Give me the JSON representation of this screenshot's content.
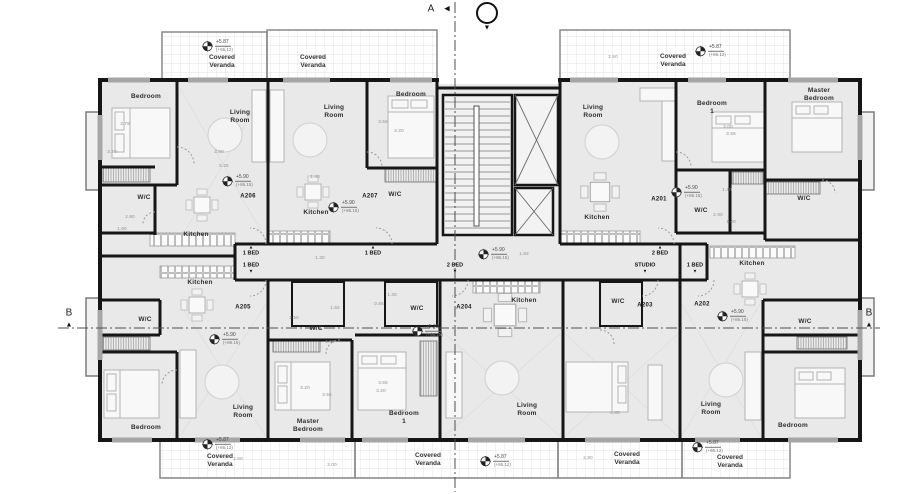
{
  "colors": {
    "wall": "#161616",
    "room_fill": "#e9e9e9",
    "veranda_fill": "#f5f5f5",
    "window": "#a6a6a6",
    "dim_text": "#8d8d8d",
    "label_text": "#2e2e2e",
    "section_line": "#555555"
  },
  "units": [
    {
      "id": "A206",
      "x": 248,
      "y": 197
    },
    {
      "id": "A207",
      "x": 370,
      "y": 197
    },
    {
      "id": "A201",
      "x": 659,
      "y": 200
    },
    {
      "id": "A205",
      "x": 243,
      "y": 308
    },
    {
      "id": "A204",
      "x": 464,
      "y": 308
    },
    {
      "id": "A203",
      "x": 645,
      "y": 306
    },
    {
      "id": "A202",
      "x": 702,
      "y": 305
    }
  ],
  "rooms": [
    {
      "text": "Bedroom",
      "x": 146,
      "y": 97
    },
    {
      "text": "Living\nRoom",
      "x": 240,
      "y": 117
    },
    {
      "text": "W/C",
      "x": 144,
      "y": 198
    },
    {
      "text": "Kitchen",
      "x": 196,
      "y": 235
    },
    {
      "text": "Living\nRoom",
      "x": 334,
      "y": 112
    },
    {
      "text": "Bedroom",
      "x": 411,
      "y": 95
    },
    {
      "text": "W/C",
      "x": 395,
      "y": 195
    },
    {
      "text": "Kitchen",
      "x": 316,
      "y": 213
    },
    {
      "text": "Living\nRoom",
      "x": 593,
      "y": 112
    },
    {
      "text": "Kitchen",
      "x": 597,
      "y": 218
    },
    {
      "text": "Bedroom\n1",
      "x": 712,
      "y": 108
    },
    {
      "text": "Master\nBedroom",
      "x": 819,
      "y": 95
    },
    {
      "text": "W/C",
      "x": 701,
      "y": 211
    },
    {
      "text": "W/C",
      "x": 804,
      "y": 199
    },
    {
      "text": "Kitchen",
      "x": 200,
      "y": 283
    },
    {
      "text": "W/C",
      "x": 145,
      "y": 320
    },
    {
      "text": "Bedroom",
      "x": 146,
      "y": 428
    },
    {
      "text": "Living\nRoom",
      "x": 243,
      "y": 412
    },
    {
      "text": "W/C",
      "x": 316,
      "y": 329
    },
    {
      "text": "Master\nBedroom",
      "x": 308,
      "y": 426
    },
    {
      "text": "Bedroom\n1",
      "x": 404,
      "y": 418
    },
    {
      "text": "W/C",
      "x": 417,
      "y": 309
    },
    {
      "text": "Kitchen",
      "x": 524,
      "y": 301
    },
    {
      "text": "Living\nRoom",
      "x": 527,
      "y": 410
    },
    {
      "text": "W/C",
      "x": 618,
      "y": 302
    },
    {
      "text": "Kitchen",
      "x": 752,
      "y": 264
    },
    {
      "text": "W/C",
      "x": 805,
      "y": 322
    },
    {
      "text": "Living\nRoom",
      "x": 711,
      "y": 409
    },
    {
      "text": "Bedroom",
      "x": 793,
      "y": 426
    }
  ],
  "corridor_labels": [
    {
      "text": "1 BED",
      "x": 251,
      "y": 251,
      "tri": "up"
    },
    {
      "text": "1 BED",
      "x": 373,
      "y": 251,
      "tri": "up"
    },
    {
      "text": "2 BED",
      "x": 660,
      "y": 251,
      "tri": "up"
    },
    {
      "text": "1 BED",
      "x": 251,
      "y": 268,
      "tri": "down"
    },
    {
      "text": "2 BED",
      "x": 455,
      "y": 268,
      "tri": "down"
    },
    {
      "text": "STUDIO",
      "x": 645,
      "y": 268,
      "tri": "down"
    },
    {
      "text": "1 BED",
      "x": 695,
      "y": 268,
      "tri": "down"
    }
  ],
  "veranda_labels": [
    {
      "text": "Covered\nVeranda",
      "x": 222,
      "y": 62
    },
    {
      "text": "Covered\nVeranda",
      "x": 313,
      "y": 62
    },
    {
      "text": "Covered\nVeranda",
      "x": 673,
      "y": 61
    },
    {
      "text": "Covered\nVeranda",
      "x": 220,
      "y": 461
    },
    {
      "text": "Covered\nVeranda",
      "x": 428,
      "y": 460
    },
    {
      "text": "Covered\nVeranda",
      "x": 627,
      "y": 459
    },
    {
      "text": "Covered\nVeranda",
      "x": 730,
      "y": 462
    }
  ],
  "elevation_markers": [
    {
      "value": "+5.87",
      "datum": "(+86.12)",
      "x": 207,
      "y": 46
    },
    {
      "value": "+5.87",
      "datum": "(+86.12)",
      "x": 700,
      "y": 51
    },
    {
      "value": "+5.90",
      "datum": "(+86.15)",
      "x": 227,
      "y": 181
    },
    {
      "value": "+5.90",
      "datum": "(+86.15)",
      "x": 333,
      "y": 207
    },
    {
      "value": "+5.90",
      "datum": "(+86.15)",
      "x": 676,
      "y": 192
    },
    {
      "value": "+5.90",
      "datum": "(+86.15)",
      "x": 483,
      "y": 254
    },
    {
      "value": "+5.90",
      "datum": "(+86.15)",
      "x": 214,
      "y": 339
    },
    {
      "value": "+5.90",
      "datum": "(+86.15)",
      "x": 417,
      "y": 331
    },
    {
      "value": "+5.90",
      "datum": "(+86.15)",
      "x": 722,
      "y": 316
    },
    {
      "value": "+5.87",
      "datum": "(+86.12)",
      "x": 207,
      "y": 444
    },
    {
      "value": "+5.87",
      "datum": "(+86.12)",
      "x": 485,
      "y": 461
    },
    {
      "value": "+5.87",
      "datum": "(+86.12)",
      "x": 697,
      "y": 447
    }
  ],
  "section_markers": [
    {
      "label": "A",
      "x": 431,
      "y": 9,
      "tri": "◀",
      "tx": 447,
      "ty": 9,
      "bubble": false
    },
    {
      "label": "",
      "x": 487,
      "y": 13,
      "tri": "▼",
      "tx": 487,
      "ty": 28,
      "bubble": true
    },
    {
      "label": "B",
      "x": 69,
      "y": 313,
      "tri": "▲",
      "tx": 69,
      "ty": 325,
      "bubble": false
    },
    {
      "label": "B",
      "x": 869,
      "y": 313,
      "tri": "▲",
      "tx": 869,
      "ty": 325,
      "bubble": false
    }
  ],
  "dimensions": [
    {
      "text": "3.79",
      "x": 125,
      "y": 124
    },
    {
      "text": "3.20",
      "x": 112,
      "y": 152
    },
    {
      "text": "3.60",
      "x": 219,
      "y": 152
    },
    {
      "text": "5.25",
      "x": 224,
      "y": 166
    },
    {
      "text": "2.90",
      "x": 130,
      "y": 217
    },
    {
      "text": "1.60",
      "x": 122,
      "y": 229
    },
    {
      "text": "2.60",
      "x": 319,
      "y": 57
    },
    {
      "text": "2.50",
      "x": 613,
      "y": 57
    },
    {
      "text": "3.55",
      "x": 383,
      "y": 122
    },
    {
      "text": "3.20",
      "x": 399,
      "y": 131
    },
    {
      "text": "1.40",
      "x": 315,
      "y": 177
    },
    {
      "text": "1.30",
      "x": 320,
      "y": 258
    },
    {
      "text": "1.82",
      "x": 524,
      "y": 254
    },
    {
      "text": "3.00",
      "x": 728,
      "y": 127
    },
    {
      "text": "3.55",
      "x": 731,
      "y": 134
    },
    {
      "text": "1.40",
      "x": 727,
      "y": 190
    },
    {
      "text": "2.90",
      "x": 718,
      "y": 215
    },
    {
      "text": "1.40",
      "x": 731,
      "y": 222
    },
    {
      "text": "1.40",
      "x": 392,
      "y": 295
    },
    {
      "text": "0.85",
      "x": 379,
      "y": 304
    },
    {
      "text": "1.65",
      "x": 335,
      "y": 308
    },
    {
      "text": "2.50",
      "x": 294,
      "y": 318
    },
    {
      "text": "1.50",
      "x": 330,
      "y": 342
    },
    {
      "text": "3.55",
      "x": 383,
      "y": 383
    },
    {
      "text": "3.20",
      "x": 381,
      "y": 391
    },
    {
      "text": "3.20",
      "x": 305,
      "y": 388
    },
    {
      "text": "3.55",
      "x": 327,
      "y": 395
    },
    {
      "text": "2.60",
      "x": 238,
      "y": 459
    },
    {
      "text": "3.00",
      "x": 332,
      "y": 465
    },
    {
      "text": "2.80",
      "x": 588,
      "y": 458
    },
    {
      "text": "4.85",
      "x": 615,
      "y": 413
    }
  ]
}
